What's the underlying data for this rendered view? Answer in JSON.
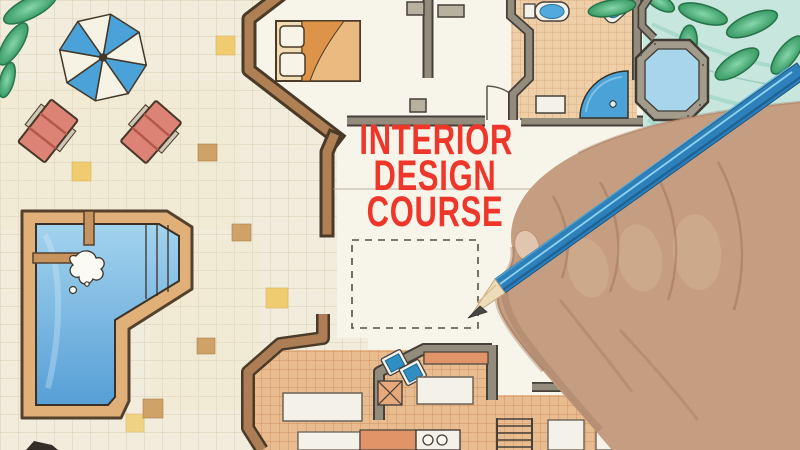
{
  "scene": {
    "kind": "photo-style illustration",
    "description": "Right hand holding a blue pencil over a hand-drawn interior design floor plan on graph paper"
  },
  "overlay": {
    "lines": [
      "INTERIOR",
      "DESIGN",
      "COURSE"
    ],
    "text_color": "#ee372a"
  },
  "floor_plan_elements": [
    "plant-leaves",
    "patio-umbrella",
    "lounge-chair",
    "lounge-chair",
    "swimming-pool",
    "pool-steps",
    "diving-board",
    "water-splash",
    "bedroom-bed",
    "corridor-door",
    "bathroom-toilet",
    "bathroom-bidet",
    "bathroom-sink",
    "corner-shower",
    "spa-tub",
    "garden-foliage",
    "kitchen-corner-sinks",
    "kitchen-island",
    "kitchen-counter",
    "stove-burners",
    "stairs",
    "dashed-room-outline",
    "pencil-guideline"
  ],
  "palette": {
    "paper": "#f1ecdb",
    "grid_line": "#d8d0b7",
    "accent_yellow": "#f0cc70",
    "accent_tan": "#cfa268",
    "umbrella_blue": "#4aa2d8",
    "chair_red": "#dc8376",
    "deck_tan": "#e0b078",
    "pool_blue": "#579fd6",
    "wall_brown": "#b08055",
    "wall_gray": "#938c7d",
    "bed_orange": "#eaba80",
    "bath_tile": "#eecfa8",
    "kitchen_tile": "#e9bc90",
    "fixture_blue": "#51a9dc",
    "leaf_green": "#3a9c66",
    "foliage_bg": "#c7e6dd",
    "skin": "#c59d81",
    "pencil_blue": "#2d80ba",
    "pencil_wood": "#ecdcba",
    "text_red": "#ee372a"
  }
}
